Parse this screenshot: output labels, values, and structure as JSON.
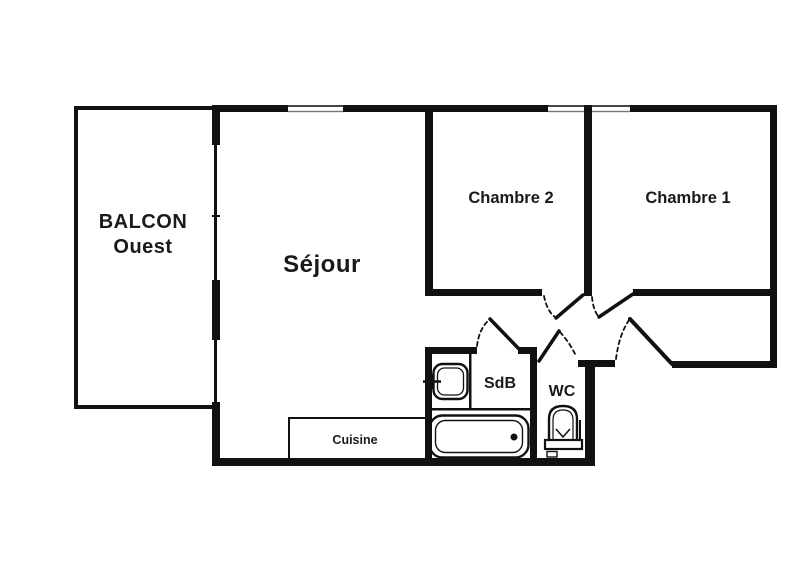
{
  "plan": {
    "type": "apartment-floor-plan",
    "rooms": {
      "balcony": {
        "line1": "BALCON",
        "line2": "Ouest"
      },
      "sejour": {
        "label": "Séjour"
      },
      "chambre2": {
        "label": "Chambre 2"
      },
      "chambre1": {
        "label": "Chambre 1"
      },
      "sdb": {
        "label": "SdB"
      },
      "wc": {
        "label": "WC"
      },
      "cuisine": {
        "label": "Cuisine"
      }
    },
    "fixtures": {
      "sink": "sink-icon",
      "bathtub": "bathtub-icon",
      "toilet": "toilet-icon"
    },
    "colors": {
      "wall": "#111111",
      "text": "#1a1a1a",
      "background": "#ffffff",
      "window_line": "#444444"
    }
  }
}
